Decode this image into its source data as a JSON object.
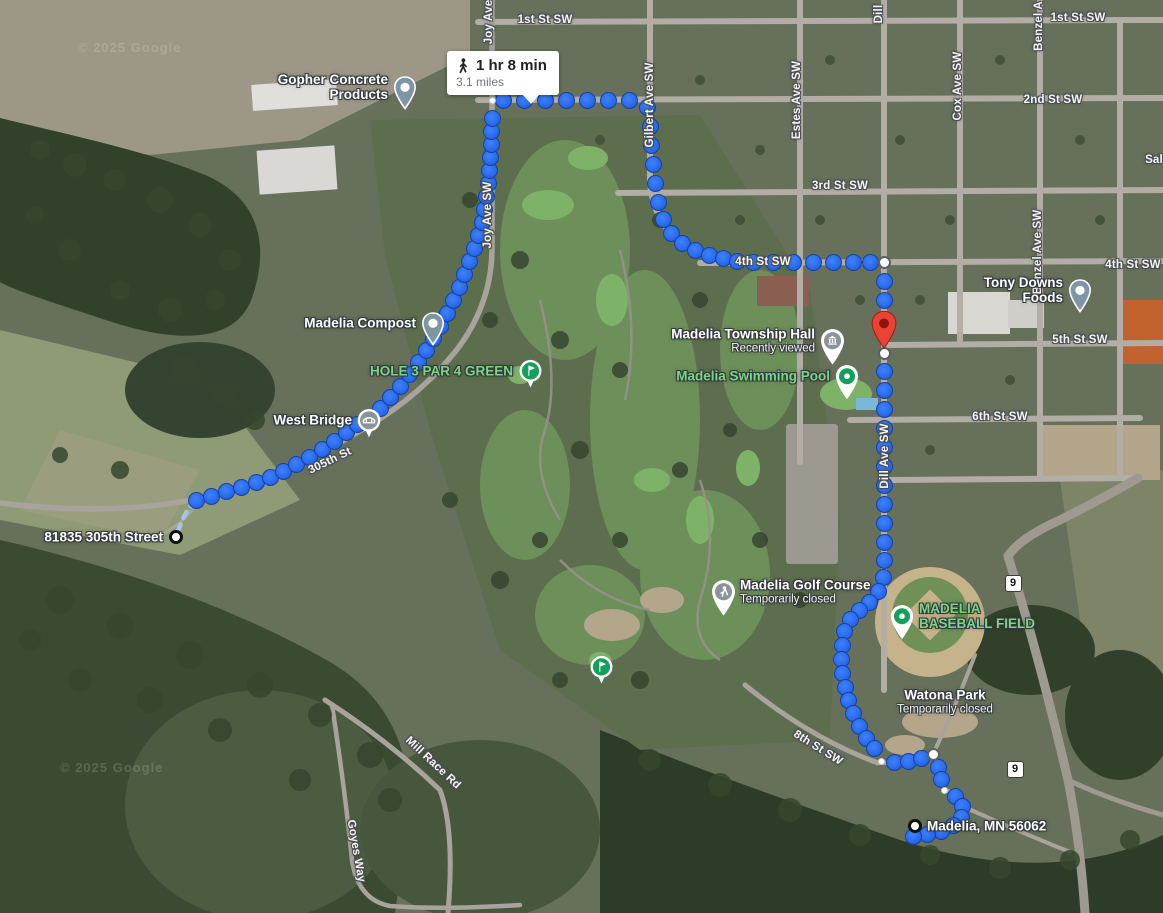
{
  "attribution": {
    "text": "© 2025 Google"
  },
  "route_bubble": {
    "duration": "1 hr 8 min",
    "distance": "3.1 miles",
    "icon": "walking-icon"
  },
  "markers": {
    "origin": {
      "label": "81835 305th Street",
      "x": 176,
      "y": 537
    },
    "destination": {
      "label": "Madelia, MN 56062",
      "x": 915,
      "y": 826
    },
    "destination_pin": {
      "x": 884,
      "y": 350,
      "color": "#ea4335"
    }
  },
  "route": {
    "dot_color": "#2a6cf0",
    "segments": [
      [
        [
          196,
          500
        ],
        [
          211,
          496
        ],
        [
          226,
          491
        ],
        [
          241,
          487
        ],
        [
          256,
          482
        ],
        [
          270,
          477
        ],
        [
          283,
          471
        ],
        [
          296,
          464
        ],
        [
          309,
          457
        ],
        [
          322,
          449
        ],
        [
          334,
          441
        ],
        [
          346,
          432
        ],
        [
          357,
          424
        ],
        [
          380,
          408
        ],
        [
          390,
          397
        ],
        [
          400,
          386
        ],
        [
          409,
          374
        ],
        [
          418,
          362
        ],
        [
          426,
          350
        ],
        [
          433,
          338
        ],
        [
          440,
          326
        ],
        [
          447,
          313
        ],
        [
          453,
          300
        ],
        [
          459,
          287
        ],
        [
          464,
          274
        ],
        [
          469,
          261
        ],
        [
          474,
          248
        ],
        [
          478,
          235
        ],
        [
          482,
          222
        ],
        [
          484,
          209
        ],
        [
          486,
          196
        ],
        [
          488,
          183
        ],
        [
          489,
          170
        ],
        [
          490,
          157
        ],
        [
          491,
          144
        ],
        [
          491,
          131
        ],
        [
          492,
          118
        ]
      ],
      [
        [
          503,
          100
        ],
        [
          524,
          100
        ],
        [
          545,
          100
        ],
        [
          566,
          100
        ],
        [
          587,
          100
        ],
        [
          608,
          100
        ],
        [
          629,
          100
        ],
        [
          647,
          107
        ]
      ],
      [
        [
          650,
          126
        ],
        [
          651,
          145
        ],
        [
          653,
          164
        ],
        [
          655,
          183
        ],
        [
          658,
          202
        ],
        [
          663,
          219
        ],
        [
          671,
          233
        ],
        [
          682,
          243
        ],
        [
          695,
          250
        ],
        [
          709,
          255
        ],
        [
          723,
          258
        ],
        [
          737,
          261
        ]
      ],
      [
        [
          753,
          262
        ],
        [
          773,
          262
        ],
        [
          793,
          262
        ],
        [
          813,
          262
        ],
        [
          833,
          262
        ],
        [
          853,
          262
        ],
        [
          870,
          262
        ]
      ],
      [
        [
          884,
          281
        ],
        [
          884,
          300
        ],
        [
          884,
          319
        ]
      ],
      [
        [
          884,
          371
        ],
        [
          884,
          390
        ],
        [
          884,
          409
        ],
        [
          884,
          428
        ],
        [
          884,
          447
        ],
        [
          884,
          466
        ],
        [
          884,
          485
        ],
        [
          884,
          504
        ],
        [
          884,
          523
        ],
        [
          884,
          542
        ],
        [
          884,
          560
        ],
        [
          883,
          577
        ]
      ],
      [
        [
          878,
          591
        ],
        [
          869,
          602
        ],
        [
          859,
          610
        ],
        [
          850,
          619
        ],
        [
          844,
          631
        ],
        [
          842,
          645
        ],
        [
          841,
          659
        ],
        [
          842,
          673
        ],
        [
          845,
          687
        ],
        [
          848,
          700
        ],
        [
          853,
          713
        ],
        [
          859,
          726
        ],
        [
          866,
          738
        ],
        [
          874,
          748
        ]
      ],
      [
        [
          894,
          762
        ],
        [
          908,
          761
        ],
        [
          921,
          758
        ]
      ],
      [
        [
          938,
          767
        ],
        [
          941,
          779
        ]
      ],
      [
        [
          955,
          796
        ],
        [
          962,
          806
        ],
        [
          961,
          817
        ],
        [
          953,
          825
        ],
        [
          941,
          831
        ],
        [
          927,
          834
        ],
        [
          913,
          836
        ]
      ]
    ],
    "small_points": [
      [
        492,
        100
      ],
      [
        881,
        761
      ],
      [
        944,
        790
      ]
    ],
    "waypoints": [
      [
        884,
        262
      ],
      [
        933,
        754
      ],
      [
        884,
        353
      ]
    ]
  },
  "pois": [
    {
      "name": "Gopher Concrete\nProducts",
      "type": "pin-dot-gray",
      "x": 405,
      "y": 87,
      "side": "left",
      "color": "white"
    },
    {
      "name": "Madelia Compost",
      "type": "pin-dot-gray",
      "x": 433,
      "y": 323,
      "side": "left",
      "color": "white"
    },
    {
      "name": "HOLE 3 PAR 4 GREEN",
      "type": "golf-badge",
      "x": 530,
      "y": 371,
      "side": "left",
      "color": "green"
    },
    {
      "name": "West Bridge",
      "type": "badge-bridge",
      "x": 369,
      "y": 420,
      "side": "left",
      "color": "white"
    },
    {
      "name": "Madelia Township Hall",
      "sub": "Recently viewed",
      "type": "pin-building",
      "x": 832,
      "y": 341,
      "side": "left",
      "color": "white"
    },
    {
      "name": "Madelia Swimming Pool",
      "type": "pin-dot-green",
      "x": 847,
      "y": 376,
      "side": "left",
      "color": "green"
    },
    {
      "name": "Tony Downs Foods",
      "type": "pin-dot-gray",
      "x": 1080,
      "y": 290,
      "side": "left",
      "color": "white"
    },
    {
      "name": "Madelia Golf Course",
      "sub": "Temporarily closed",
      "type": "pin-golfer",
      "x": 723,
      "y": 592,
      "side": "right",
      "color": "white"
    },
    {
      "name": "MADELIA\nBASEBALL FIELD",
      "type": "pin-dot-green",
      "x": 902,
      "y": 616,
      "side": "right",
      "color": "green"
    },
    {
      "name": "Watona Park",
      "sub": "Temporarily closed",
      "type": "none",
      "x": 945,
      "y": 702,
      "side": "center",
      "color": "white"
    },
    {
      "name": "",
      "type": "golf-badge",
      "x": 601,
      "y": 667,
      "side": "none",
      "color": "green"
    }
  ],
  "street_labels": [
    {
      "text": "1st St SW",
      "x": 545,
      "y": 20,
      "rot": 0
    },
    {
      "text": "1st St SW",
      "x": 1078,
      "y": 18,
      "rot": 0
    },
    {
      "text": "2nd St SW",
      "x": 1053,
      "y": 100,
      "rot": 0
    },
    {
      "text": "3rd St SW",
      "x": 840,
      "y": 186,
      "rot": 0
    },
    {
      "text": "4th St SW",
      "x": 763,
      "y": 262,
      "rot": 0
    },
    {
      "text": "4th St SW",
      "x": 1133,
      "y": 265,
      "rot": 0
    },
    {
      "text": "5th St SW",
      "x": 1080,
      "y": 340,
      "rot": 0
    },
    {
      "text": "6th St SW",
      "x": 1000,
      "y": 417,
      "rot": 0
    },
    {
      "text": "8th St SW",
      "x": 818,
      "y": 748,
      "rot": 32
    },
    {
      "text": "305th St",
      "x": 330,
      "y": 461,
      "rot": -26
    },
    {
      "text": "Mill Race Rd",
      "x": 433,
      "y": 763,
      "rot": 43
    },
    {
      "text": "Goyes Way",
      "x": 356,
      "y": 851,
      "rot": 80
    },
    {
      "text": "Joy Ave",
      "x": 489,
      "y": 22,
      "rot": -90
    },
    {
      "text": "Joy Ave SW",
      "x": 488,
      "y": 215,
      "rot": -90
    },
    {
      "text": "Gilbert Ave SW",
      "x": 650,
      "y": 105,
      "rot": -90
    },
    {
      "text": "Estes Ave SW",
      "x": 797,
      "y": 100,
      "rot": -90
    },
    {
      "text": "Cox Ave SW",
      "x": 958,
      "y": 86,
      "rot": -90
    },
    {
      "text": "Dill",
      "x": 879,
      "y": 14,
      "rot": -90
    },
    {
      "text": "Dill Ave SW",
      "x": 885,
      "y": 456,
      "rot": -90
    },
    {
      "text": "Benzel A",
      "x": 1039,
      "y": 26,
      "rot": -90
    },
    {
      "text": "Benzel Ave SW",
      "x": 1038,
      "y": 252,
      "rot": -90
    },
    {
      "text": "Sal",
      "x": 1154,
      "y": 160,
      "rot": 0
    }
  ],
  "shields": [
    {
      "text": "9",
      "x": 1013,
      "y": 583
    },
    {
      "text": "9",
      "x": 1015,
      "y": 769
    }
  ]
}
